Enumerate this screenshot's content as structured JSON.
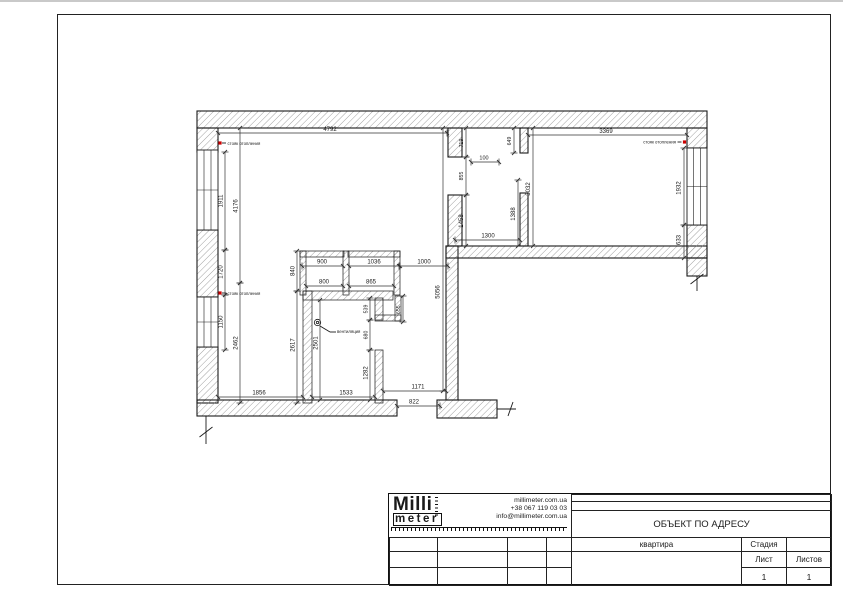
{
  "plan": {
    "hatch_color": "#8a8a8a",
    "wall_outline": "#1a1a1a",
    "riser_color": "#cc0000",
    "walls": [
      {
        "x": 197,
        "y": 111,
        "w": 510,
        "h": 17
      },
      {
        "x": 197,
        "y": 128,
        "w": 21,
        "h": 24
      },
      {
        "x": 197,
        "y": 230,
        "w": 21,
        "h": 67
      },
      {
        "x": 197,
        "y": 347,
        "w": 21,
        "h": 56
      },
      {
        "x": 197,
        "y": 400,
        "w": 200,
        "h": 16
      },
      {
        "x": 437,
        "y": 400,
        "w": 60,
        "h": 18
      },
      {
        "x": 446,
        "y": 246,
        "w": 12,
        "h": 154
      },
      {
        "x": 446,
        "y": 246,
        "w": 261,
        "h": 12
      },
      {
        "x": 687,
        "y": 128,
        "w": 20,
        "h": 20
      },
      {
        "x": 687,
        "y": 225,
        "w": 20,
        "h": 33
      },
      {
        "x": 687,
        "y": 258,
        "w": 20,
        "h": 18
      },
      {
        "x": 448,
        "y": 128,
        "w": 14,
        "h": 29
      },
      {
        "x": 448,
        "y": 195,
        "w": 14,
        "h": 51
      },
      {
        "x": 520,
        "y": 128,
        "w": 8,
        "h": 25
      },
      {
        "x": 520,
        "y": 193,
        "w": 8,
        "h": 53
      },
      {
        "x": 300,
        "y": 251,
        "w": 44,
        "h": 6,
        "t": 1
      },
      {
        "x": 348,
        "y": 251,
        "w": 52,
        "h": 6,
        "t": 1
      },
      {
        "x": 343,
        "y": 251,
        "w": 6,
        "h": 44,
        "t": 1
      },
      {
        "x": 300,
        "y": 251,
        "w": 6,
        "h": 44,
        "t": 1
      },
      {
        "x": 394,
        "y": 251,
        "w": 6,
        "h": 44,
        "t": 1
      },
      {
        "x": 303,
        "y": 291,
        "w": 90,
        "h": 9,
        "t": 1
      },
      {
        "x": 303,
        "y": 291,
        "w": 9,
        "h": 112,
        "t": 1
      },
      {
        "x": 375,
        "y": 298,
        "w": 8,
        "h": 22,
        "t": 1
      },
      {
        "x": 395,
        "y": 296,
        "w": 6,
        "h": 25,
        "t": 1
      },
      {
        "x": 375,
        "y": 315,
        "w": 26,
        "h": 6,
        "t": 1
      },
      {
        "x": 375,
        "y": 350,
        "w": 8,
        "h": 53,
        "t": 1
      }
    ],
    "windows": [
      {
        "x": 197,
        "y": 150,
        "w": 21,
        "h": 80
      },
      {
        "x": 197,
        "y": 297,
        "w": 21,
        "h": 50
      },
      {
        "x": 687,
        "y": 148,
        "w": 20,
        "h": 77
      }
    ],
    "dims": [
      {
        "t": "4792",
        "x1": 218,
        "y1": 133,
        "x2": 447,
        "y2": 133,
        "tx": 330,
        "ty": 131,
        "r": 0
      },
      {
        "t": "3369",
        "x1": 528,
        "y1": 135,
        "x2": 687,
        "y2": 135,
        "tx": 606,
        "ty": 133,
        "r": 0
      },
      {
        "t": "100",
        "x1": 471,
        "y1": 162,
        "x2": 499,
        "y2": 162,
        "tx": 484,
        "ty": 159.5,
        "r": 0,
        "s": 5.5
      },
      {
        "t": "1300",
        "x1": 455,
        "y1": 240,
        "x2": 520,
        "y2": 240,
        "tx": 488,
        "ty": 237.5,
        "r": 0
      },
      {
        "t": "900",
        "x1": 302,
        "y1": 266,
        "x2": 343,
        "y2": 266,
        "tx": 322,
        "ty": 263.5,
        "r": 0
      },
      {
        "t": "1036",
        "x1": 349,
        "y1": 266,
        "x2": 399,
        "y2": 266,
        "tx": 374,
        "ty": 263.5,
        "r": 0
      },
      {
        "t": "1000",
        "x1": 400,
        "y1": 266,
        "x2": 448,
        "y2": 266,
        "tx": 424,
        "ty": 263.5,
        "r": 0
      },
      {
        "t": "800",
        "x1": 306,
        "y1": 286,
        "x2": 343,
        "y2": 286,
        "tx": 324,
        "ty": 283.5,
        "r": 0
      },
      {
        "t": "865",
        "x1": 349,
        "y1": 286,
        "x2": 394,
        "y2": 286,
        "tx": 371,
        "ty": 283.5,
        "r": 0
      },
      {
        "t": "1856",
        "x1": 218,
        "y1": 397,
        "x2": 303,
        "y2": 397,
        "tx": 259,
        "ty": 394.5,
        "r": 0
      },
      {
        "t": "1533",
        "x1": 312,
        "y1": 397,
        "x2": 375,
        "y2": 397,
        "tx": 346,
        "ty": 394.5,
        "r": 0
      },
      {
        "t": "1171",
        "x1": 383,
        "y1": 391,
        "x2": 446,
        "y2": 391,
        "tx": 418,
        "ty": 388.5,
        "r": 0
      },
      {
        "t": "822",
        "x1": 397,
        "y1": 406,
        "x2": 440,
        "y2": 406,
        "tx": 414,
        "ty": 403.5,
        "r": 0
      },
      {
        "t": "1911",
        "x1": 225,
        "y1": 152,
        "x2": 225,
        "y2": 250,
        "tx": 222.5,
        "ty": 201,
        "r": -90
      },
      {
        "t": "4176",
        "x1": 240,
        "y1": 128,
        "x2": 240,
        "y2": 283,
        "tx": 237.5,
        "ty": 206,
        "r": -90
      },
      {
        "t": "1720",
        "x1": 225,
        "y1": 250,
        "x2": 225,
        "y2": 295,
        "tx": 222.5,
        "ty": 272,
        "r": -90
      },
      {
        "t": "1150",
        "x1": 225,
        "y1": 295,
        "x2": 225,
        "y2": 350,
        "tx": 222.5,
        "ty": 322,
        "r": -90
      },
      {
        "t": "2462",
        "x1": 240,
        "y1": 283,
        "x2": 240,
        "y2": 403,
        "tx": 237.5,
        "ty": 343,
        "r": -90
      },
      {
        "t": "2617",
        "x1": 297,
        "y1": 291,
        "x2": 297,
        "y2": 403,
        "tx": 294.5,
        "ty": 345,
        "r": -90
      },
      {
        "t": "840",
        "x1": 297,
        "y1": 251,
        "x2": 297,
        "y2": 291,
        "tx": 294.5,
        "ty": 271,
        "r": -90
      },
      {
        "t": "2501",
        "x1": 320,
        "y1": 300,
        "x2": 320,
        "y2": 400,
        "tx": 317.5,
        "ty": 343,
        "r": -90
      },
      {
        "t": "539",
        "x1": 370,
        "y1": 298,
        "x2": 370,
        "y2": 320,
        "tx": 367.5,
        "ty": 309,
        "r": -90,
        "s": 5.2
      },
      {
        "t": "680",
        "x1": 370,
        "y1": 320,
        "x2": 370,
        "y2": 350,
        "tx": 367.5,
        "ty": 335,
        "r": -90,
        "s": 5.2
      },
      {
        "t": "1282",
        "x1": 370,
        "y1": 350,
        "x2": 370,
        "y2": 400,
        "tx": 367.5,
        "ty": 373,
        "r": -90
      },
      {
        "t": "655.",
        "x1": 403,
        "y1": 296,
        "x2": 403,
        "y2": 322,
        "tx": 400,
        "ty": 309,
        "r": -90,
        "s": 5.2
      },
      {
        "t": "5056",
        "x1": 443,
        "y1": 128,
        "x2": 443,
        "y2": 391,
        "tx": 439.5,
        "ty": 292,
        "r": -90
      },
      {
        "t": "719",
        "x1": 466,
        "y1": 128,
        "x2": 466,
        "y2": 157,
        "tx": 463,
        "ty": 143,
        "r": -90,
        "s": 5.2
      },
      {
        "t": "855",
        "x1": 466,
        "y1": 157,
        "x2": 466,
        "y2": 195,
        "tx": 463,
        "ty": 176,
        "r": -90,
        "s": 5.2
      },
      {
        "t": "1458",
        "x1": 466,
        "y1": 195,
        "x2": 466,
        "y2": 246,
        "tx": 463,
        "ty": 221,
        "r": -90
      },
      {
        "t": "649",
        "x1": 514,
        "y1": 128,
        "x2": 514,
        "y2": 153,
        "tx": 511,
        "ty": 141,
        "r": -90,
        "s": 5.2
      },
      {
        "t": "1388",
        "x1": 518,
        "y1": 180,
        "x2": 518,
        "y2": 246,
        "tx": 515,
        "ty": 214,
        "r": -90
      },
      {
        "t": "3032",
        "x1": 533,
        "y1": 128,
        "x2": 533,
        "y2": 246,
        "tx": 530,
        "ty": 189,
        "r": -90
      },
      {
        "t": "1932",
        "x1": 684,
        "y1": 148,
        "x2": 684,
        "y2": 225,
        "tx": 680.5,
        "ty": 188,
        "r": -90
      },
      {
        "t": "633",
        "x1": 684,
        "y1": 225,
        "x2": 684,
        "y2": 258,
        "tx": 680.5,
        "ty": 240,
        "r": -90
      }
    ],
    "labels": [
      {
        "t": "стояк отопления",
        "x": 227.5,
        "y": 145,
        "a": "start"
      },
      {
        "t": "стояк отопления",
        "x": 227.5,
        "y": 295,
        "a": "start"
      },
      {
        "t": "стояк отопления",
        "x": 676,
        "y": 143.5,
        "a": "end"
      },
      {
        "t": "вентиляция",
        "x": 337,
        "y": 333,
        "a": "start"
      }
    ],
    "risers": [
      {
        "x": 220,
        "y": 143
      },
      {
        "x": 220,
        "y": 293
      },
      {
        "x": 684.5,
        "y": 142
      }
    ],
    "lines": [
      {
        "x1": 222,
        "y1": 143,
        "x2": 226,
        "y2": 143
      },
      {
        "x1": 222,
        "y1": 293,
        "x2": 226,
        "y2": 293
      },
      {
        "x1": 677.5,
        "y1": 142,
        "x2": 681.5,
        "y2": 142
      },
      {
        "x1": 206,
        "y1": 416,
        "x2": 206,
        "y2": 444
      },
      {
        "x1": 199.5,
        "y1": 437,
        "x2": 212.5,
        "y2": 427
      },
      {
        "x1": 497,
        "y1": 409,
        "x2": 516,
        "y2": 409
      },
      {
        "x1": 508,
        "y1": 416,
        "x2": 513,
        "y2": 402
      },
      {
        "x1": 697,
        "y1": 276,
        "x2": 697,
        "y2": 291
      },
      {
        "x1": 690.5,
        "y1": 284,
        "x2": 703.5,
        "y2": 274
      },
      {
        "x1": 320,
        "y1": 326,
        "x2": 330,
        "y2": 332
      },
      {
        "x1": 330,
        "y1": 332,
        "x2": 336,
        "y2": 332
      }
    ],
    "circles": [
      {
        "cx": 317.5,
        "cy": 322.5,
        "r": 3.2
      },
      {
        "cx": 317.5,
        "cy": 322.5,
        "r": 1.2
      }
    ]
  },
  "titleblock": {
    "logo": {
      "line1": "Milli",
      "line2": "meter"
    },
    "contacts": [
      "millimeter.com.ua",
      "+38 067 119 03 03",
      "info@millimeter.com.ua"
    ],
    "object_title": "ОБЪЕКТ ПО АДРЕСУ",
    "subject": "квартира",
    "stage_label": "Стадия",
    "sheet_label": "Лист",
    "sheets_label": "Листов",
    "sheet_value": "1",
    "sheets_value": "1"
  }
}
